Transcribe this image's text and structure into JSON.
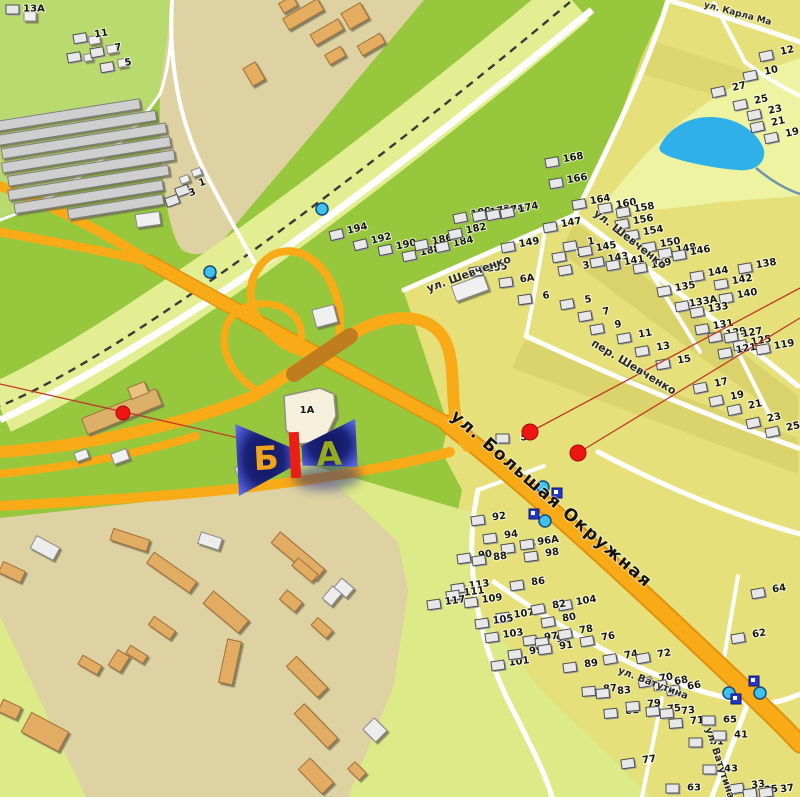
{
  "map": {
    "colors": {
      "grass": "#97c73d",
      "grass_light": "#b9da6e",
      "pale_band": "#e3ee92",
      "beige": "#ded2a2",
      "residential": "#e6e07a",
      "olive_strip": "#d2ca62",
      "pond_strip": "#eef3a2",
      "pale_wedge": "#dcea88",
      "road_orange": "#f8ab17",
      "road_casing": "#e0920c",
      "bridge": "#bf7d1f",
      "road_white": "#ffffff",
      "pond": "#2fb0e8",
      "rail": "#3a3a3a",
      "poi_red": "#ee1612",
      "line_red": "#c03a28",
      "marker_navy": "#1b2278",
      "icon_cyan": "#3fc1ee",
      "icon_navy": "#2636c8"
    },
    "marker": {
      "x": 296,
      "y": 456,
      "side_b": "Б",
      "side_a": "А",
      "side_b_color": "#f0a41d",
      "side_a_color": "#95aa1c",
      "board_color": "#ea1d17"
    },
    "building_1a_label": "1А",
    "streets": [
      {
        "name": "ул. Шевченко",
        "x": 470,
        "y": 277,
        "rot": -20,
        "size": 11
      },
      {
        "name": "ул. Шевченко",
        "x": 628,
        "y": 242,
        "rot": 38,
        "size": 11
      },
      {
        "name": "пер. Шевченко",
        "x": 632,
        "y": 370,
        "rot": 31,
        "size": 11
      },
      {
        "name": "ул. Большая Окружная",
        "x": 548,
        "y": 503,
        "rot": 41,
        "size": 17,
        "big": true
      },
      {
        "name": "ул. Ватутина",
        "x": 652,
        "y": 686,
        "rot": 21,
        "size": 10
      },
      {
        "name": "ул. Ватутина",
        "x": 717,
        "y": 764,
        "rot": 72,
        "size": 10
      },
      {
        "name": "ул. Карла Ма",
        "x": 737,
        "y": 16,
        "rot": 15,
        "size": 9
      }
    ],
    "houses": [
      {
        "t": "13А",
        "x": 34,
        "y": 8,
        "r": 0
      },
      {
        "t": "11",
        "x": 101,
        "y": 33,
        "r": -10
      },
      {
        "t": "9",
        "x": 95,
        "y": 52,
        "r": -10
      },
      {
        "t": "7",
        "x": 118,
        "y": 47,
        "r": -10
      },
      {
        "t": "5",
        "x": 128,
        "y": 62,
        "r": -10
      },
      {
        "t": "1",
        "x": 202,
        "y": 182,
        "r": -20
      },
      {
        "t": "3",
        "x": 192,
        "y": 192,
        "r": -20
      },
      {
        "t": "194",
        "x": 357,
        "y": 228,
        "r": -14
      },
      {
        "t": "192",
        "x": 381,
        "y": 238,
        "r": -14
      },
      {
        "t": "190",
        "x": 406,
        "y": 244,
        "r": -12
      },
      {
        "t": "188",
        "x": 430,
        "y": 250,
        "r": -12
      },
      {
        "t": "186",
        "x": 442,
        "y": 239,
        "r": -12
      },
      {
        "t": "184",
        "x": 463,
        "y": 241,
        "r": -12
      },
      {
        "t": "182",
        "x": 476,
        "y": 228,
        "r": -12
      },
      {
        "t": "180",
        "x": 481,
        "y": 212,
        "r": -12
      },
      {
        "t": "178",
        "x": 500,
        "y": 210,
        "r": -12
      },
      {
        "t": "176",
        "x": 514,
        "y": 209,
        "r": -12
      },
      {
        "t": "174",
        "x": 528,
        "y": 207,
        "r": -12
      },
      {
        "t": "168",
        "x": 573,
        "y": 157,
        "r": -10
      },
      {
        "t": "166",
        "x": 577,
        "y": 178,
        "r": -10
      },
      {
        "t": "164",
        "x": 600,
        "y": 199,
        "r": -10
      },
      {
        "t": "160",
        "x": 626,
        "y": 203,
        "r": -10
      },
      {
        "t": "158",
        "x": 644,
        "y": 207,
        "r": -10
      },
      {
        "t": "156",
        "x": 643,
        "y": 219,
        "r": -10
      },
      {
        "t": "154",
        "x": 653,
        "y": 230,
        "r": -10
      },
      {
        "t": "150",
        "x": 670,
        "y": 242,
        "r": -10
      },
      {
        "t": "148",
        "x": 686,
        "y": 248,
        "r": -10
      },
      {
        "t": "146",
        "x": 700,
        "y": 250,
        "r": -10
      },
      {
        "t": "144",
        "x": 718,
        "y": 271,
        "r": -10
      },
      {
        "t": "142",
        "x": 742,
        "y": 279,
        "r": -10
      },
      {
        "t": "140",
        "x": 747,
        "y": 293,
        "r": -10
      },
      {
        "t": "138",
        "x": 766,
        "y": 263,
        "r": -10
      },
      {
        "t": "135",
        "x": 685,
        "y": 286,
        "r": -10
      },
      {
        "t": "133А",
        "x": 703,
        "y": 301,
        "r": -10
      },
      {
        "t": "133",
        "x": 718,
        "y": 307,
        "r": -10
      },
      {
        "t": "131",
        "x": 723,
        "y": 324,
        "r": -10
      },
      {
        "t": "129",
        "x": 736,
        "y": 332,
        "r": -10
      },
      {
        "t": "127",
        "x": 752,
        "y": 332,
        "r": -10
      },
      {
        "t": "125",
        "x": 761,
        "y": 340,
        "r": -10
      },
      {
        "t": "121",
        "x": 746,
        "y": 348,
        "r": -10
      },
      {
        "t": "119",
        "x": 784,
        "y": 344,
        "r": -10
      },
      {
        "t": "12",
        "x": 787,
        "y": 50,
        "r": -12
      },
      {
        "t": "10",
        "x": 771,
        "y": 70,
        "r": -12
      },
      {
        "t": "27",
        "x": 739,
        "y": 86,
        "r": -12
      },
      {
        "t": "25",
        "x": 761,
        "y": 99,
        "r": -12
      },
      {
        "t": "23",
        "x": 775,
        "y": 109,
        "r": -12
      },
      {
        "t": "21",
        "x": 778,
        "y": 121,
        "r": -12
      },
      {
        "t": "19",
        "x": 792,
        "y": 132,
        "r": -12
      },
      {
        "t": "147",
        "x": 571,
        "y": 222,
        "r": -10
      },
      {
        "t": "149",
        "x": 529,
        "y": 242,
        "r": -10
      },
      {
        "t": "155",
        "x": 497,
        "y": 267,
        "r": -8
      },
      {
        "t": "1",
        "x": 591,
        "y": 241,
        "r": -10
      },
      {
        "t": "2",
        "x": 580,
        "y": 252,
        "r": -10
      },
      {
        "t": "3",
        "x": 586,
        "y": 265,
        "r": -10
      },
      {
        "t": "145",
        "x": 606,
        "y": 246,
        "r": -10
      },
      {
        "t": "143",
        "x": 618,
        "y": 257,
        "r": -10
      },
      {
        "t": "141",
        "x": 634,
        "y": 260,
        "r": -10
      },
      {
        "t": "139",
        "x": 661,
        "y": 263,
        "r": -10
      },
      {
        "t": "6А",
        "x": 527,
        "y": 278,
        "r": -8
      },
      {
        "t": "6",
        "x": 546,
        "y": 295,
        "r": -8
      },
      {
        "t": "5",
        "x": 588,
        "y": 299,
        "r": -10
      },
      {
        "t": "7",
        "x": 606,
        "y": 311,
        "r": -10
      },
      {
        "t": "9",
        "x": 618,
        "y": 324,
        "r": -10
      },
      {
        "t": "11",
        "x": 645,
        "y": 333,
        "r": -10
      },
      {
        "t": "13",
        "x": 663,
        "y": 346,
        "r": -10
      },
      {
        "t": "15",
        "x": 684,
        "y": 359,
        "r": -10
      },
      {
        "t": "17",
        "x": 721,
        "y": 382,
        "r": -12
      },
      {
        "t": "19",
        "x": 737,
        "y": 395,
        "r": -12
      },
      {
        "t": "21",
        "x": 755,
        "y": 404,
        "r": -12
      },
      {
        "t": "23",
        "x": 774,
        "y": 417,
        "r": -12
      },
      {
        "t": "25",
        "x": 793,
        "y": 426,
        "r": -12
      },
      {
        "t": "5",
        "x": 524,
        "y": 437,
        "r": 0
      },
      {
        "t": "92",
        "x": 499,
        "y": 516,
        "r": -8
      },
      {
        "t": "94",
        "x": 511,
        "y": 534,
        "r": -8
      },
      {
        "t": "96",
        "x": 529,
        "y": 544,
        "r": -8
      },
      {
        "t": "96А",
        "x": 548,
        "y": 540,
        "r": -8
      },
      {
        "t": "98",
        "x": 552,
        "y": 552,
        "r": -8
      },
      {
        "t": "90",
        "x": 485,
        "y": 554,
        "r": -8
      },
      {
        "t": "88",
        "x": 500,
        "y": 556,
        "r": -8
      },
      {
        "t": "86",
        "x": 538,
        "y": 581,
        "r": -8
      },
      {
        "t": "113",
        "x": 479,
        "y": 584,
        "r": -8
      },
      {
        "t": "111",
        "x": 474,
        "y": 591,
        "r": -8
      },
      {
        "t": "109",
        "x": 492,
        "y": 598,
        "r": -8
      },
      {
        "t": "117",
        "x": 455,
        "y": 600,
        "r": -8
      },
      {
        "t": "107",
        "x": 524,
        "y": 613,
        "r": -8
      },
      {
        "t": "105",
        "x": 503,
        "y": 619,
        "r": -8
      },
      {
        "t": "103",
        "x": 513,
        "y": 633,
        "r": -8
      },
      {
        "t": "101",
        "x": 519,
        "y": 661,
        "r": -8
      },
      {
        "t": "99",
        "x": 536,
        "y": 650,
        "r": -8
      },
      {
        "t": "97",
        "x": 551,
        "y": 636,
        "r": -8
      },
      {
        "t": "95",
        "x": 563,
        "y": 638,
        "r": -8
      },
      {
        "t": "91",
        "x": 566,
        "y": 645,
        "r": -8
      },
      {
        "t": "89",
        "x": 591,
        "y": 663,
        "r": -8
      },
      {
        "t": "104",
        "x": 586,
        "y": 600,
        "r": -10
      },
      {
        "t": "82",
        "x": 559,
        "y": 604,
        "r": -10
      },
      {
        "t": "80",
        "x": 569,
        "y": 617,
        "r": -10
      },
      {
        "t": "78",
        "x": 586,
        "y": 629,
        "r": -10
      },
      {
        "t": "76",
        "x": 608,
        "y": 636,
        "r": -10
      },
      {
        "t": "74",
        "x": 631,
        "y": 654,
        "r": -10
      },
      {
        "t": "72",
        "x": 664,
        "y": 653,
        "r": -10
      },
      {
        "t": "70",
        "x": 666,
        "y": 677,
        "r": -10
      },
      {
        "t": "68",
        "x": 681,
        "y": 680,
        "r": -10
      },
      {
        "t": "66",
        "x": 694,
        "y": 685,
        "r": -10
      },
      {
        "t": "87",
        "x": 610,
        "y": 688,
        "r": -5
      },
      {
        "t": "83",
        "x": 624,
        "y": 690,
        "r": -5
      },
      {
        "t": "81",
        "x": 632,
        "y": 710,
        "r": -5
      },
      {
        "t": "79",
        "x": 654,
        "y": 703,
        "r": -5
      },
      {
        "t": "75",
        "x": 674,
        "y": 708,
        "r": -5
      },
      {
        "t": "73",
        "x": 688,
        "y": 710,
        "r": -5
      },
      {
        "t": "71",
        "x": 697,
        "y": 720,
        "r": -5
      },
      {
        "t": "77",
        "x": 649,
        "y": 759,
        "r": -8
      },
      {
        "t": "65",
        "x": 730,
        "y": 719,
        "r": 0
      },
      {
        "t": "61",
        "x": 717,
        "y": 741,
        "r": 0
      },
      {
        "t": "41",
        "x": 741,
        "y": 734,
        "r": 0
      },
      {
        "t": "43",
        "x": 731,
        "y": 768,
        "r": 0
      },
      {
        "t": "63",
        "x": 694,
        "y": 787,
        "r": 0
      },
      {
        "t": "64",
        "x": 779,
        "y": 588,
        "r": -10
      },
      {
        "t": "62",
        "x": 759,
        "y": 633,
        "r": -10
      },
      {
        "t": "33",
        "x": 758,
        "y": 784,
        "r": -8
      },
      {
        "t": "35",
        "x": 771,
        "y": 789,
        "r": -8
      },
      {
        "t": "37",
        "x": 787,
        "y": 788,
        "r": -8
      }
    ],
    "poi_dots": [
      {
        "x": 123,
        "y": 413,
        "r": 7
      },
      {
        "x": 530,
        "y": 432,
        "r": 8
      },
      {
        "x": 578,
        "y": 453,
        "r": 8
      }
    ],
    "poi_lines": [
      [
        0,
        384,
        292,
        450
      ],
      [
        530,
        432,
        800,
        288
      ],
      [
        578,
        453,
        800,
        318
      ]
    ],
    "info_dots": [
      {
        "x": 322,
        "y": 209
      },
      {
        "x": 210,
        "y": 272
      },
      {
        "x": 543,
        "y": 487
      },
      {
        "x": 545,
        "y": 521
      },
      {
        "x": 729,
        "y": 693
      },
      {
        "x": 760,
        "y": 693
      }
    ],
    "stop_signs": [
      {
        "x": 557,
        "y": 493
      },
      {
        "x": 534,
        "y": 514
      },
      {
        "x": 754,
        "y": 681
      },
      {
        "x": 736,
        "y": 699
      }
    ]
  }
}
